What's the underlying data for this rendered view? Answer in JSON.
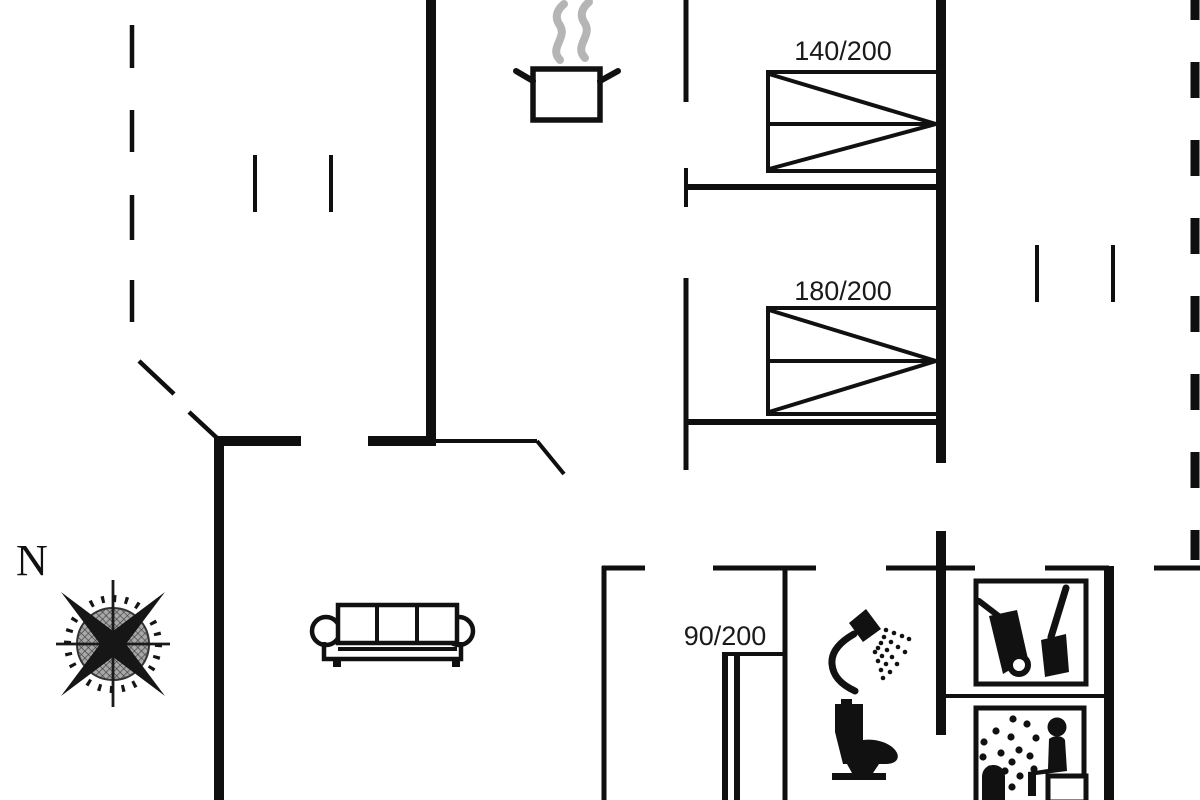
{
  "meta": {
    "diagram_type": "vacation-house floor plan",
    "background_color": "#ffffff",
    "line_color": "#111111",
    "steam_color": "#b5b5b5",
    "label_color": "#1a1a1a"
  },
  "compass": {
    "label": "N"
  },
  "beds": [
    {
      "id": "double-bed-top",
      "label": "140/200"
    },
    {
      "id": "double-bed-middle",
      "label": "180/200"
    },
    {
      "id": "single-bed-hall",
      "label": "90/200"
    }
  ],
  "icons": [
    {
      "name": "cooking-pot-icon"
    },
    {
      "name": "sofa-icon"
    },
    {
      "name": "shower-icon"
    },
    {
      "name": "toilet-icon"
    },
    {
      "name": "wheelbarrow-icon"
    },
    {
      "name": "spade-icon"
    },
    {
      "name": "sauna-icon"
    },
    {
      "name": "compass-rose-icon"
    }
  ]
}
